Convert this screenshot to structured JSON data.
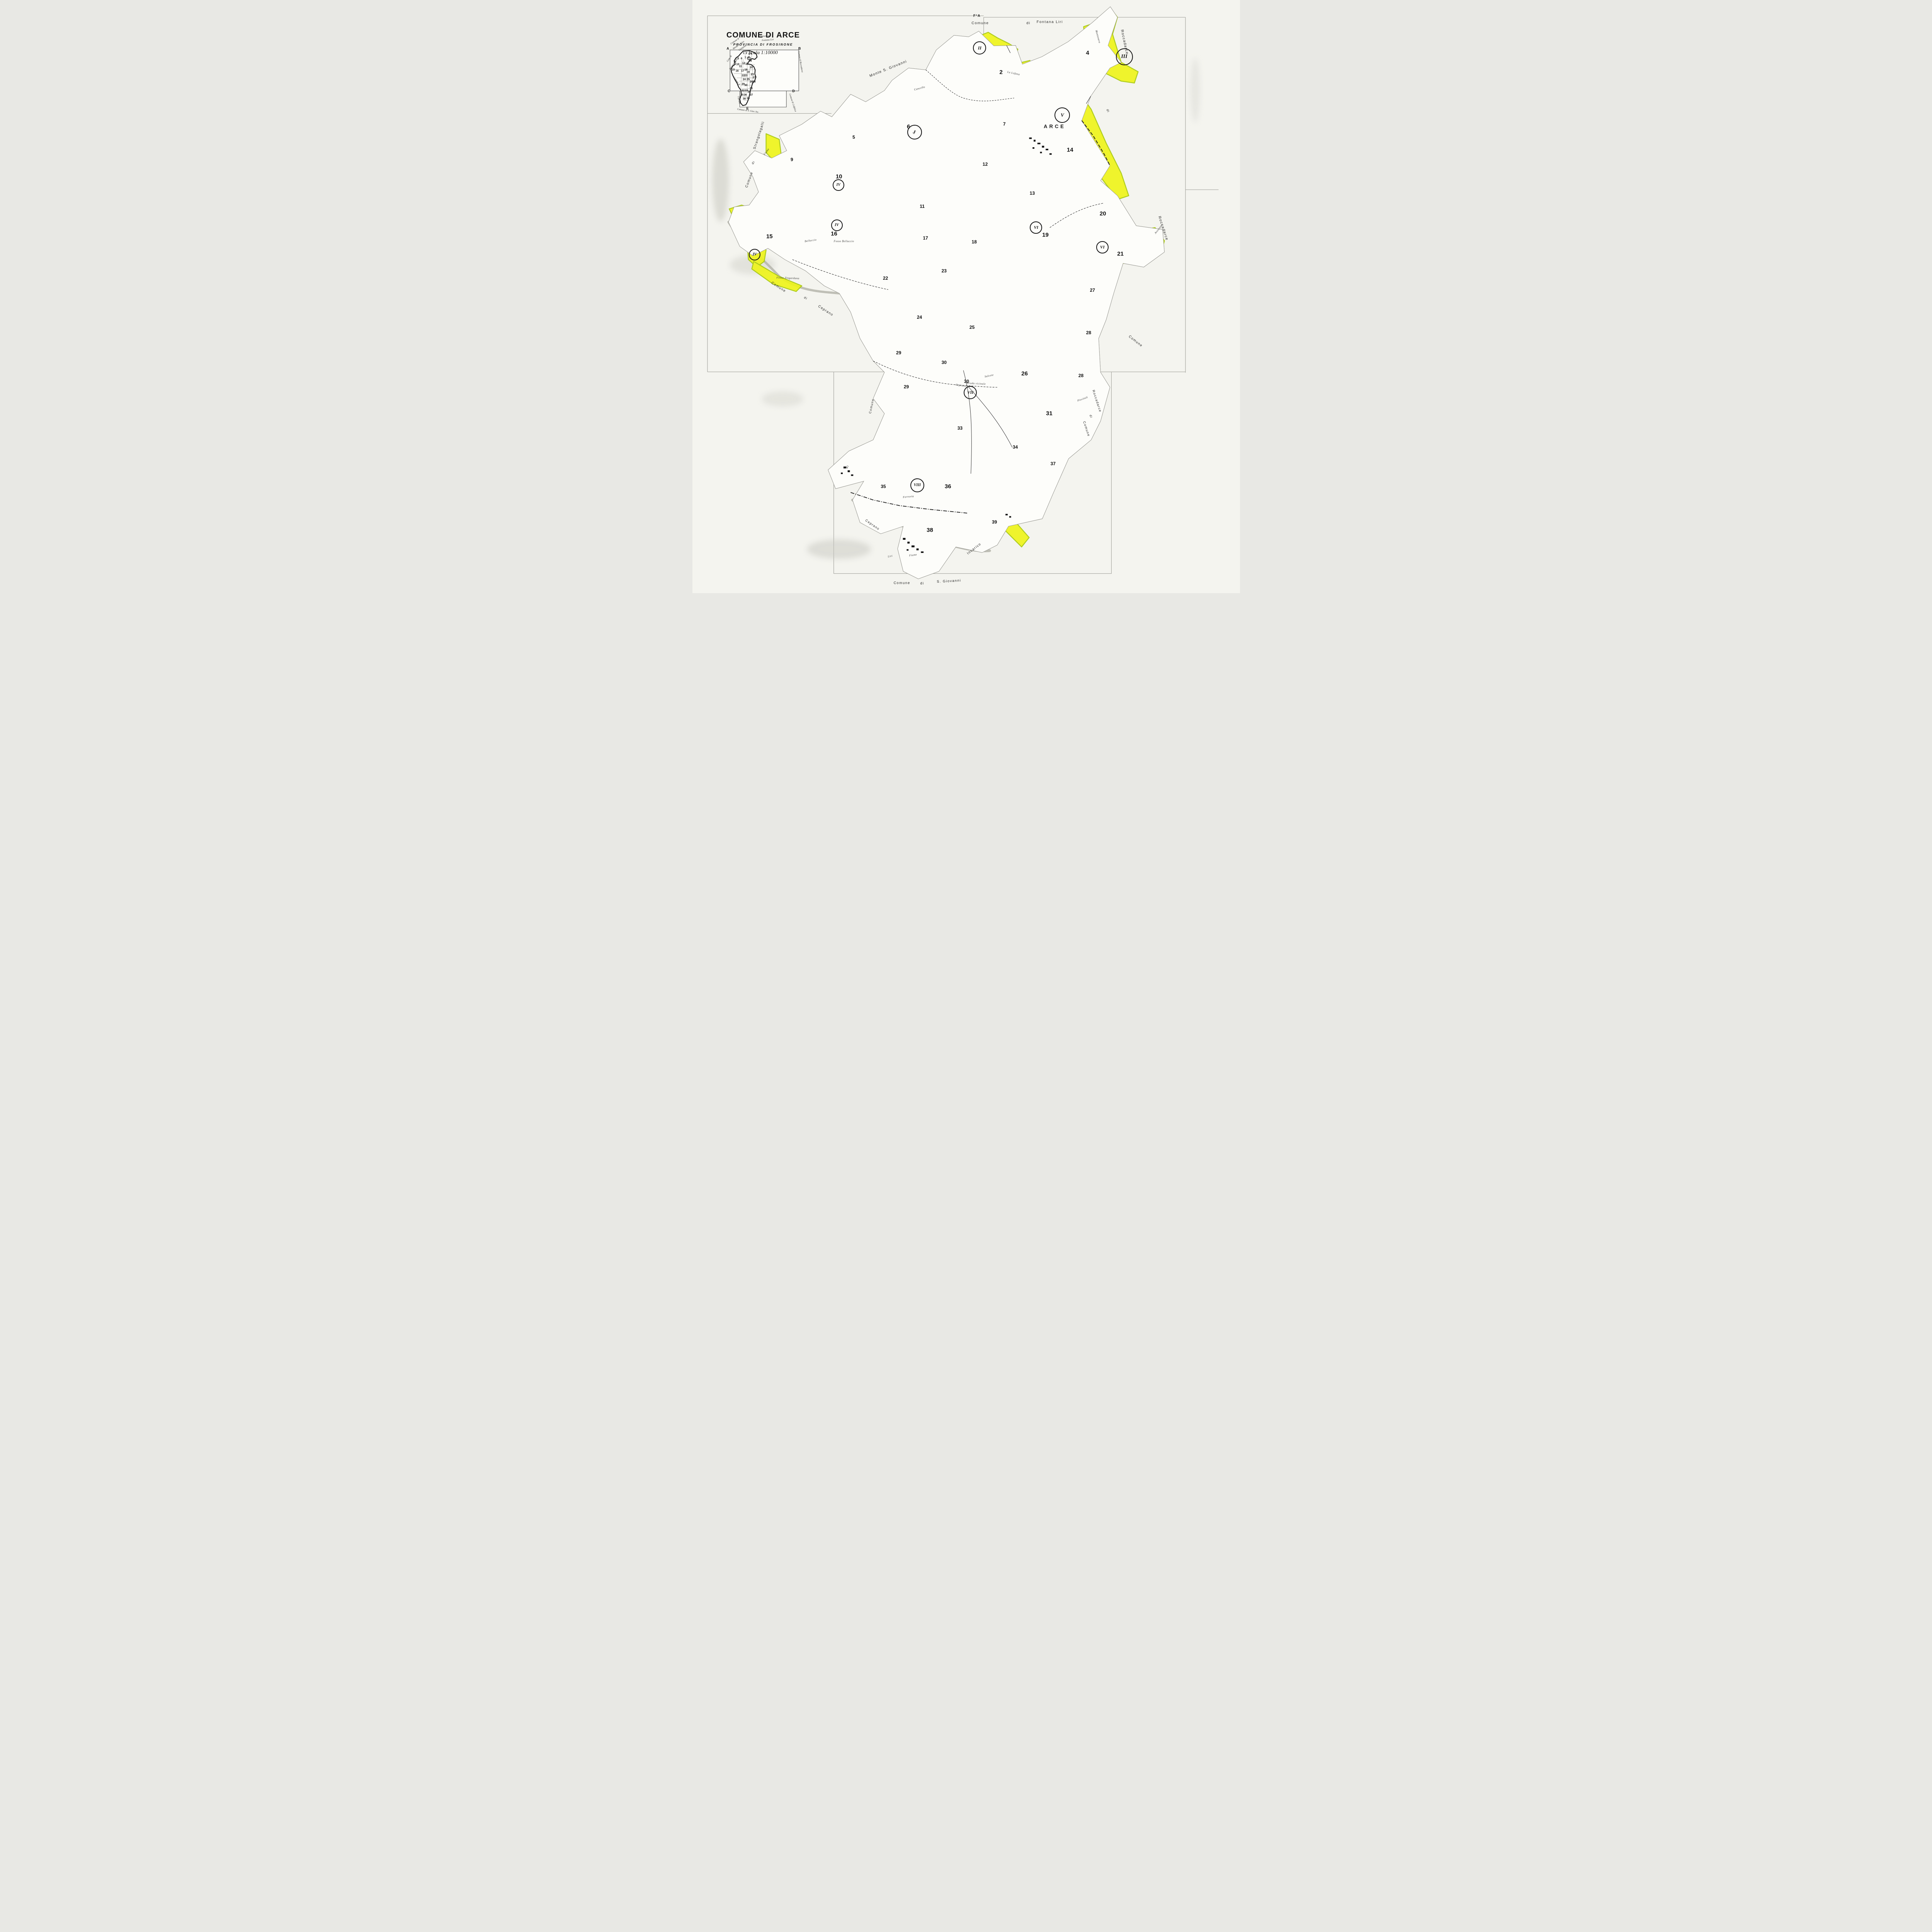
{
  "colors": {
    "highlight": "#eef41c",
    "highlight_edge": "#a9c90f",
    "paper": "#f4f4ef",
    "map_white": "#fdfdfa",
    "ink": "#151515",
    "parcel_line": "#80807a",
    "scan_shadow": "#c8c8c0"
  },
  "title_block": {
    "title": "COMUNE DI ARCE",
    "subtitle": "PROVINCIA DI FROSINONE",
    "scale_label": "Scala 1:10000"
  },
  "sheet_corner_label": "F°A",
  "index_map": {
    "corner_letters": [
      {
        "t": "A",
        "x": 6.5,
        "y": 8.2
      },
      {
        "t": "B",
        "x": 19.6,
        "y": 8.2
      },
      {
        "t": "C",
        "x": 6.7,
        "y": 15.4
      },
      {
        "t": "D",
        "x": 18.5,
        "y": 15.4
      },
      {
        "t": "E",
        "x": 10.1,
        "y": 18.3
      }
    ],
    "numbers": [
      {
        "t": "1",
        "x": 9.4,
        "y": 9.0
      },
      {
        "t": "2",
        "x": 9.9,
        "y": 9.0
      },
      {
        "t": "3",
        "x": 10.4,
        "y": 9.1
      },
      {
        "t": "4",
        "x": 10.8,
        "y": 9.1
      },
      {
        "t": "5",
        "x": 8.4,
        "y": 9.9
      },
      {
        "t": "6",
        "x": 9.0,
        "y": 9.9
      },
      {
        "t": "7",
        "x": 9.7,
        "y": 9.8
      },
      {
        "t": "8",
        "x": 10.3,
        "y": 9.8
      },
      {
        "t": "9",
        "x": 7.8,
        "y": 10.5
      },
      {
        "t": "10",
        "x": 8.3,
        "y": 10.9
      },
      {
        "t": "11",
        "x": 8.8,
        "y": 11.2
      },
      {
        "t": "12",
        "x": 9.4,
        "y": 10.7
      },
      {
        "t": "13",
        "x": 10.0,
        "y": 10.8
      },
      {
        "t": "14",
        "x": 10.6,
        "y": 10.3
      },
      {
        "t": "15",
        "x": 7.5,
        "y": 11.8
      },
      {
        "t": "16",
        "x": 8.2,
        "y": 12.0
      },
      {
        "t": "17",
        "x": 9.2,
        "y": 12.0
      },
      {
        "t": "18",
        "x": 9.8,
        "y": 11.8
      },
      {
        "t": "19",
        "x": 10.2,
        "y": 12.2
      },
      {
        "t": "20",
        "x": 10.8,
        "y": 11.4
      },
      {
        "t": "21",
        "x": 11.0,
        "y": 12.6
      },
      {
        "t": "22",
        "x": 9.3,
        "y": 12.8
      },
      {
        "t": "23",
        "x": 9.8,
        "y": 12.8
      },
      {
        "t": "24",
        "x": 9.5,
        "y": 13.4
      },
      {
        "t": "25",
        "x": 10.2,
        "y": 13.4
      },
      {
        "t": "26",
        "x": 10.8,
        "y": 13.8
      },
      {
        "t": "27",
        "x": 11.3,
        "y": 13.1
      },
      {
        "t": "28",
        "x": 11.3,
        "y": 13.8
      },
      {
        "t": "29",
        "x": 9.3,
        "y": 14.2
      },
      {
        "t": "30",
        "x": 9.8,
        "y": 14.4
      },
      {
        "t": "31",
        "x": 10.8,
        "y": 14.9
      },
      {
        "t": "32",
        "x": 9.3,
        "y": 15.3
      },
      {
        "t": "33",
        "x": 9.9,
        "y": 15.3
      },
      {
        "t": "34",
        "x": 10.4,
        "y": 15.5
      },
      {
        "t": "35",
        "x": 9.1,
        "y": 16.0
      },
      {
        "t": "36",
        "x": 9.7,
        "y": 16.0
      },
      {
        "t": "37",
        "x": 10.8,
        "y": 16.0
      },
      {
        "t": "38",
        "x": 9.5,
        "y": 16.7
      },
      {
        "t": "39",
        "x": 10.2,
        "y": 16.6
      }
    ],
    "labels": [
      {
        "t": "Comune di",
        "x": 13.2,
        "y": 6.1,
        "r": -4
      },
      {
        "t": "Fontana Liri",
        "x": 13.8,
        "y": 6.8,
        "r": -4
      },
      {
        "t": "Comune di",
        "x": 7.8,
        "y": 7.0,
        "r": -35
      },
      {
        "t": "Monte S. Giov.",
        "x": 8.5,
        "y": 7.6,
        "r": -35
      },
      {
        "t": "Campana",
        "x": 9.2,
        "y": 8.1,
        "r": -35
      },
      {
        "t": "Com. di",
        "x": 6.8,
        "y": 9.9,
        "r": -55
      },
      {
        "t": "Strangolagalli",
        "x": 7.6,
        "y": 10.8,
        "r": -55
      },
      {
        "t": "Comune di Roccadarce",
        "x": 19.7,
        "y": 10.4,
        "r": 80
      },
      {
        "t": "Comune di",
        "x": 8.1,
        "y": 13.7,
        "r": 55
      },
      {
        "t": "Ceprano",
        "x": 8.5,
        "y": 16.9,
        "r": 80
      },
      {
        "t": "Comune di Colfelice",
        "x": 18.3,
        "y": 17.3,
        "r": 72
      },
      {
        "t": "Comune di S. Giov. Inc.",
        "x": 10.2,
        "y": 18.7,
        "r": 8
      }
    ]
  },
  "map": {
    "town_label": "ARCE",
    "zone_markers": [
      {
        "t": "I",
        "x": 40.6,
        "y": 22.3,
        "d": 34,
        "fs": 11
      },
      {
        "t": "II",
        "x": 52.5,
        "y": 8.1,
        "d": 30,
        "fs": 12
      },
      {
        "t": "III",
        "x": 78.9,
        "y": 9.6,
        "d": 40,
        "fs": 14
      },
      {
        "t": "IV",
        "x": 26.7,
        "y": 31.2,
        "d": 26,
        "fs": 10
      },
      {
        "t": "IV",
        "x": 26.4,
        "y": 38.0,
        "d": 26,
        "fs": 10
      },
      {
        "t": "IV",
        "x": 11.4,
        "y": 42.9,
        "d": 26,
        "fs": 10
      },
      {
        "t": "V",
        "x": 67.6,
        "y": 19.4,
        "d": 36,
        "fs": 13
      },
      {
        "t": "VI",
        "x": 62.8,
        "y": 38.4,
        "d": 28,
        "fs": 11
      },
      {
        "t": "VI",
        "x": 74.9,
        "y": 41.7,
        "d": 28,
        "fs": 11
      },
      {
        "t": "VII",
        "x": 50.8,
        "y": 66.2,
        "d": 30,
        "fs": 11
      },
      {
        "t": "VIII",
        "x": 41.1,
        "y": 81.8,
        "d": 32,
        "fs": 10
      }
    ],
    "sheet_numbers": [
      {
        "t": "2",
        "x": 56.4,
        "y": 12.2,
        "c": "big"
      },
      {
        "t": "4",
        "x": 72.2,
        "y": 8.9,
        "c": "big"
      },
      {
        "t": "5",
        "x": 29.5,
        "y": 23.1
      },
      {
        "t": "6",
        "x": 39.5,
        "y": 21.4,
        "c": "big"
      },
      {
        "t": "7",
        "x": 57.0,
        "y": 20.9
      },
      {
        "t": "9",
        "x": 18.2,
        "y": 26.9
      },
      {
        "t": "10",
        "x": 26.8,
        "y": 29.8,
        "c": "big"
      },
      {
        "t": "11",
        "x": 42.0,
        "y": 34.8
      },
      {
        "t": "12",
        "x": 53.5,
        "y": 27.7
      },
      {
        "t": "13",
        "x": 62.1,
        "y": 32.6
      },
      {
        "t": "14",
        "x": 69.0,
        "y": 25.3,
        "c": "big"
      },
      {
        "t": "15",
        "x": 14.1,
        "y": 39.9,
        "c": "big"
      },
      {
        "t": "16",
        "x": 25.9,
        "y": 39.4,
        "c": "big"
      },
      {
        "t": "17",
        "x": 42.6,
        "y": 40.1
      },
      {
        "t": "18",
        "x": 51.5,
        "y": 40.8
      },
      {
        "t": "19",
        "x": 64.5,
        "y": 39.6,
        "c": "big"
      },
      {
        "t": "20",
        "x": 75.0,
        "y": 36.0,
        "c": "big"
      },
      {
        "t": "21",
        "x": 78.2,
        "y": 42.8,
        "c": "big"
      },
      {
        "t": "22",
        "x": 35.3,
        "y": 46.9
      },
      {
        "t": "23",
        "x": 46.0,
        "y": 45.7
      },
      {
        "t": "24",
        "x": 41.5,
        "y": 53.5
      },
      {
        "t": "25",
        "x": 51.1,
        "y": 55.2
      },
      {
        "t": "26",
        "x": 60.7,
        "y": 63.0,
        "c": "big"
      },
      {
        "t": "27",
        "x": 73.1,
        "y": 48.9
      },
      {
        "t": "28",
        "x": 72.4,
        "y": 56.1
      },
      {
        "t": "28",
        "x": 71.0,
        "y": 63.3
      },
      {
        "t": "29",
        "x": 37.7,
        "y": 59.5
      },
      {
        "t": "29",
        "x": 39.1,
        "y": 65.2
      },
      {
        "t": "30",
        "x": 46.0,
        "y": 61.1
      },
      {
        "t": "30",
        "x": 50.1,
        "y": 64.3
      },
      {
        "t": "31",
        "x": 65.2,
        "y": 69.7,
        "c": "big"
      },
      {
        "t": "33",
        "x": 48.9,
        "y": 72.2
      },
      {
        "t": "34",
        "x": 59.0,
        "y": 75.4
      },
      {
        "t": "35",
        "x": 34.9,
        "y": 82.0
      },
      {
        "t": "36",
        "x": 46.7,
        "y": 82.0,
        "c": "big"
      },
      {
        "t": "37",
        "x": 65.9,
        "y": 78.2
      },
      {
        "t": "38",
        "x": 43.4,
        "y": 89.4,
        "c": "big"
      },
      {
        "t": "39",
        "x": 55.2,
        "y": 88.0
      }
    ],
    "neighbor_labels": [
      {
        "t": "Comune",
        "x": 52.6,
        "y": 3.9,
        "fs": 9.5
      },
      {
        "t": "di",
        "x": 61.4,
        "y": 3.9,
        "fs": 9.5
      },
      {
        "t": "Fontana Liri",
        "x": 65.3,
        "y": 3.7,
        "fs": 9.5
      },
      {
        "t": "Monte  S. Giovanni",
        "x": 35.8,
        "y": 11.6,
        "r": -22,
        "fs": 9.5
      },
      {
        "t": "Strangolagalli",
        "x": 12.2,
        "y": 22.8,
        "r": -72,
        "fs": 9
      },
      {
        "t": "di",
        "x": 11.2,
        "y": 27.4,
        "r": -60,
        "fs": 8
      },
      {
        "t": "Comune",
        "x": 10.4,
        "y": 30.3,
        "r": -70,
        "fs": 9
      },
      {
        "t": "Comune",
        "x": 15.8,
        "y": 48.4,
        "r": 33,
        "fs": 9
      },
      {
        "t": "di",
        "x": 20.7,
        "y": 50.3,
        "r": 33,
        "fs": 8
      },
      {
        "t": "Ceprano",
        "x": 24.4,
        "y": 52.4,
        "r": 33,
        "fs": 9
      },
      {
        "t": "Comune",
        "x": 32.8,
        "y": 68.5,
        "r": -78,
        "fs": 8
      },
      {
        "t": "di",
        "x": 28.3,
        "y": 78.7,
        "r": -60,
        "fs": 7.5
      },
      {
        "t": "Ceprano",
        "x": 32.9,
        "y": 88.5,
        "r": 35,
        "fs": 8.5
      },
      {
        "t": "Comune",
        "x": 38.3,
        "y": 98.3,
        "fs": 9
      },
      {
        "t": "di",
        "x": 42.0,
        "y": 98.4,
        "fs": 9
      },
      {
        "t": "S. Giovanni",
        "x": 46.9,
        "y": 98.0,
        "r": -3,
        "fs": 9
      },
      {
        "t": "Incarico",
        "x": 51.5,
        "y": 92.5,
        "r": -38,
        "fs": 9
      },
      {
        "t": "Roccadarce",
        "x": 78.9,
        "y": 7.1,
        "r": 78,
        "fs": 9.5
      },
      {
        "t": "di",
        "x": 75.9,
        "y": 18.7,
        "r": 70,
        "fs": 8
      },
      {
        "t": "Roccadarce",
        "x": 86.0,
        "y": 38.5,
        "r": 72,
        "fs": 9.5
      },
      {
        "t": "Comune",
        "x": 81.0,
        "y": 57.5,
        "r": 38,
        "fs": 9
      },
      {
        "t": "Roccadarce",
        "x": 73.9,
        "y": 67.6,
        "r": 72,
        "fs": 8.5
      },
      {
        "t": "di",
        "x": 72.8,
        "y": 70.2,
        "r": 72,
        "fs": 8
      },
      {
        "t": "Comune",
        "x": 72.0,
        "y": 72.3,
        "r": 72,
        "fs": 8.5
      }
    ],
    "street_labels": [
      {
        "t": "Rio",
        "x": 40.6,
        "y": 22.3,
        "r": -55
      },
      {
        "t": "Fiume",
        "x": 13.6,
        "y": 25.6,
        "r": -55
      },
      {
        "t": "La Lefana",
        "x": 58.7,
        "y": 12.4,
        "r": 12
      },
      {
        "t": "Montenero",
        "x": 74.1,
        "y": 6.2,
        "r": 75
      },
      {
        "t": "Cancello",
        "x": 41.5,
        "y": 14.9,
        "r": -15
      },
      {
        "t": "Belluccio",
        "x": 21.6,
        "y": 40.6,
        "r": -8
      },
      {
        "t": "Fosso Belluccio",
        "x": 27.7,
        "y": 40.7
      },
      {
        "t": "Fosso Zingardana",
        "x": 17.5,
        "y": 46.9,
        "r": 2
      },
      {
        "t": "Strada vicinale",
        "x": 51.8,
        "y": 64.7,
        "r": 3
      },
      {
        "t": "Ceprano",
        "x": 49.1,
        "y": 65.0,
        "r": 8
      },
      {
        "t": "Salcete",
        "x": 54.2,
        "y": 63.4,
        "r": -12
      },
      {
        "t": "Avezzano",
        "x": 85.2,
        "y": 38.6,
        "r": -52
      },
      {
        "t": "Piovitoli",
        "x": 71.3,
        "y": 67.3,
        "r": -20
      },
      {
        "t": "Ferrovia",
        "x": 39.5,
        "y": 83.8,
        "r": -5
      },
      {
        "t": "Liri",
        "x": 36.2,
        "y": 93.8,
        "r": -10
      },
      {
        "t": "Fiume",
        "x": 40.3,
        "y": 93.6,
        "r": -8
      }
    ]
  }
}
